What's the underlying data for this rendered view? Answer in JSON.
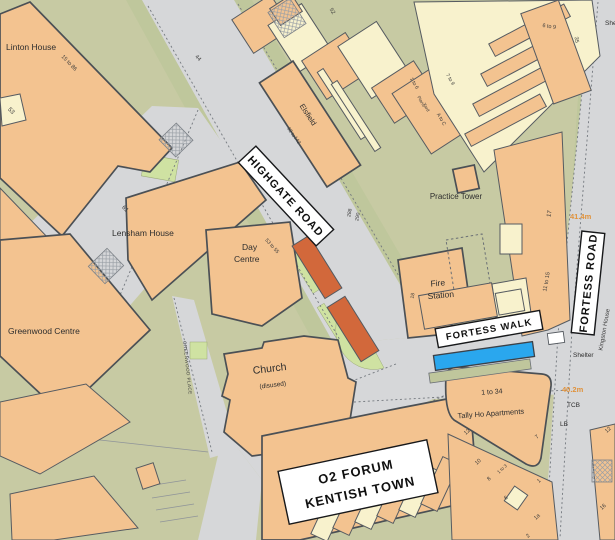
{
  "map": {
    "colors": {
      "road": "#d6d7d9",
      "land": "#c7caa3",
      "building": "#f3c390",
      "building_pale": "#f8f2cd",
      "grass": "#cfe2a2",
      "highlight_red": "#d2683b",
      "highlight_blue": "#2aa7ee",
      "spot_height": "#e0923c",
      "outline": "#565b61"
    },
    "signs": {
      "highgate_road": "HIGHGATE ROAD",
      "fortess_road": "FORTESS ROAD",
      "fortess_walk": "FORTESS WALK",
      "o2_line1": "O2 FORUM",
      "o2_line2": "KENTISH TOWN"
    },
    "places": {
      "linton": "Linton House",
      "lensham": "Lensham House",
      "greenwood": "Greenwood Centre",
      "day_a": "Day",
      "day_b": "Centre",
      "church": "Church",
      "disused": "(disused)",
      "elsfield": "Elsfield",
      "practice": "Practice Tower",
      "fire_a": "Fire",
      "fire_b": "Station",
      "tally_a": "1 to 34",
      "tally_b": "Tally Ho Apartments",
      "kingston": "Kingston House",
      "piano_a": "Piano",
      "piano_b": "Yard",
      "greenwood_place": "GREENWOOD PLACE",
      "shelter_mid": "Shelter",
      "shelter_top": "Shelter"
    },
    "spots": {
      "s1": "41.4m",
      "s2": "40.2m"
    },
    "misc": {
      "tcb": "TCB",
      "lb": "LB"
    },
    "nums": {
      "n61": "61",
      "n53": "53",
      "n44": "44",
      "n52": "52",
      "n15_86": "15 to 86",
      "n53_55": "53 to 55",
      "n62": "62 to",
      "n142": "142",
      "n288": "288",
      "n290": "290",
      "n17": "17",
      "n11_15": "11 to 15",
      "n35": "35",
      "n6_9": "6 to 9",
      "n1_6": "1 to 6",
      "n7_9": "7 to 9",
      "nac": "A to C",
      "n18": "18",
      "n12": "12",
      "n12b": "12",
      "n10": "10",
      "n8": "8",
      "n6": "6",
      "n7": "7",
      "n1_3": "1 to 3",
      "n1": "1",
      "n1a": "1a",
      "n2": "2",
      "n16": "16"
    }
  }
}
